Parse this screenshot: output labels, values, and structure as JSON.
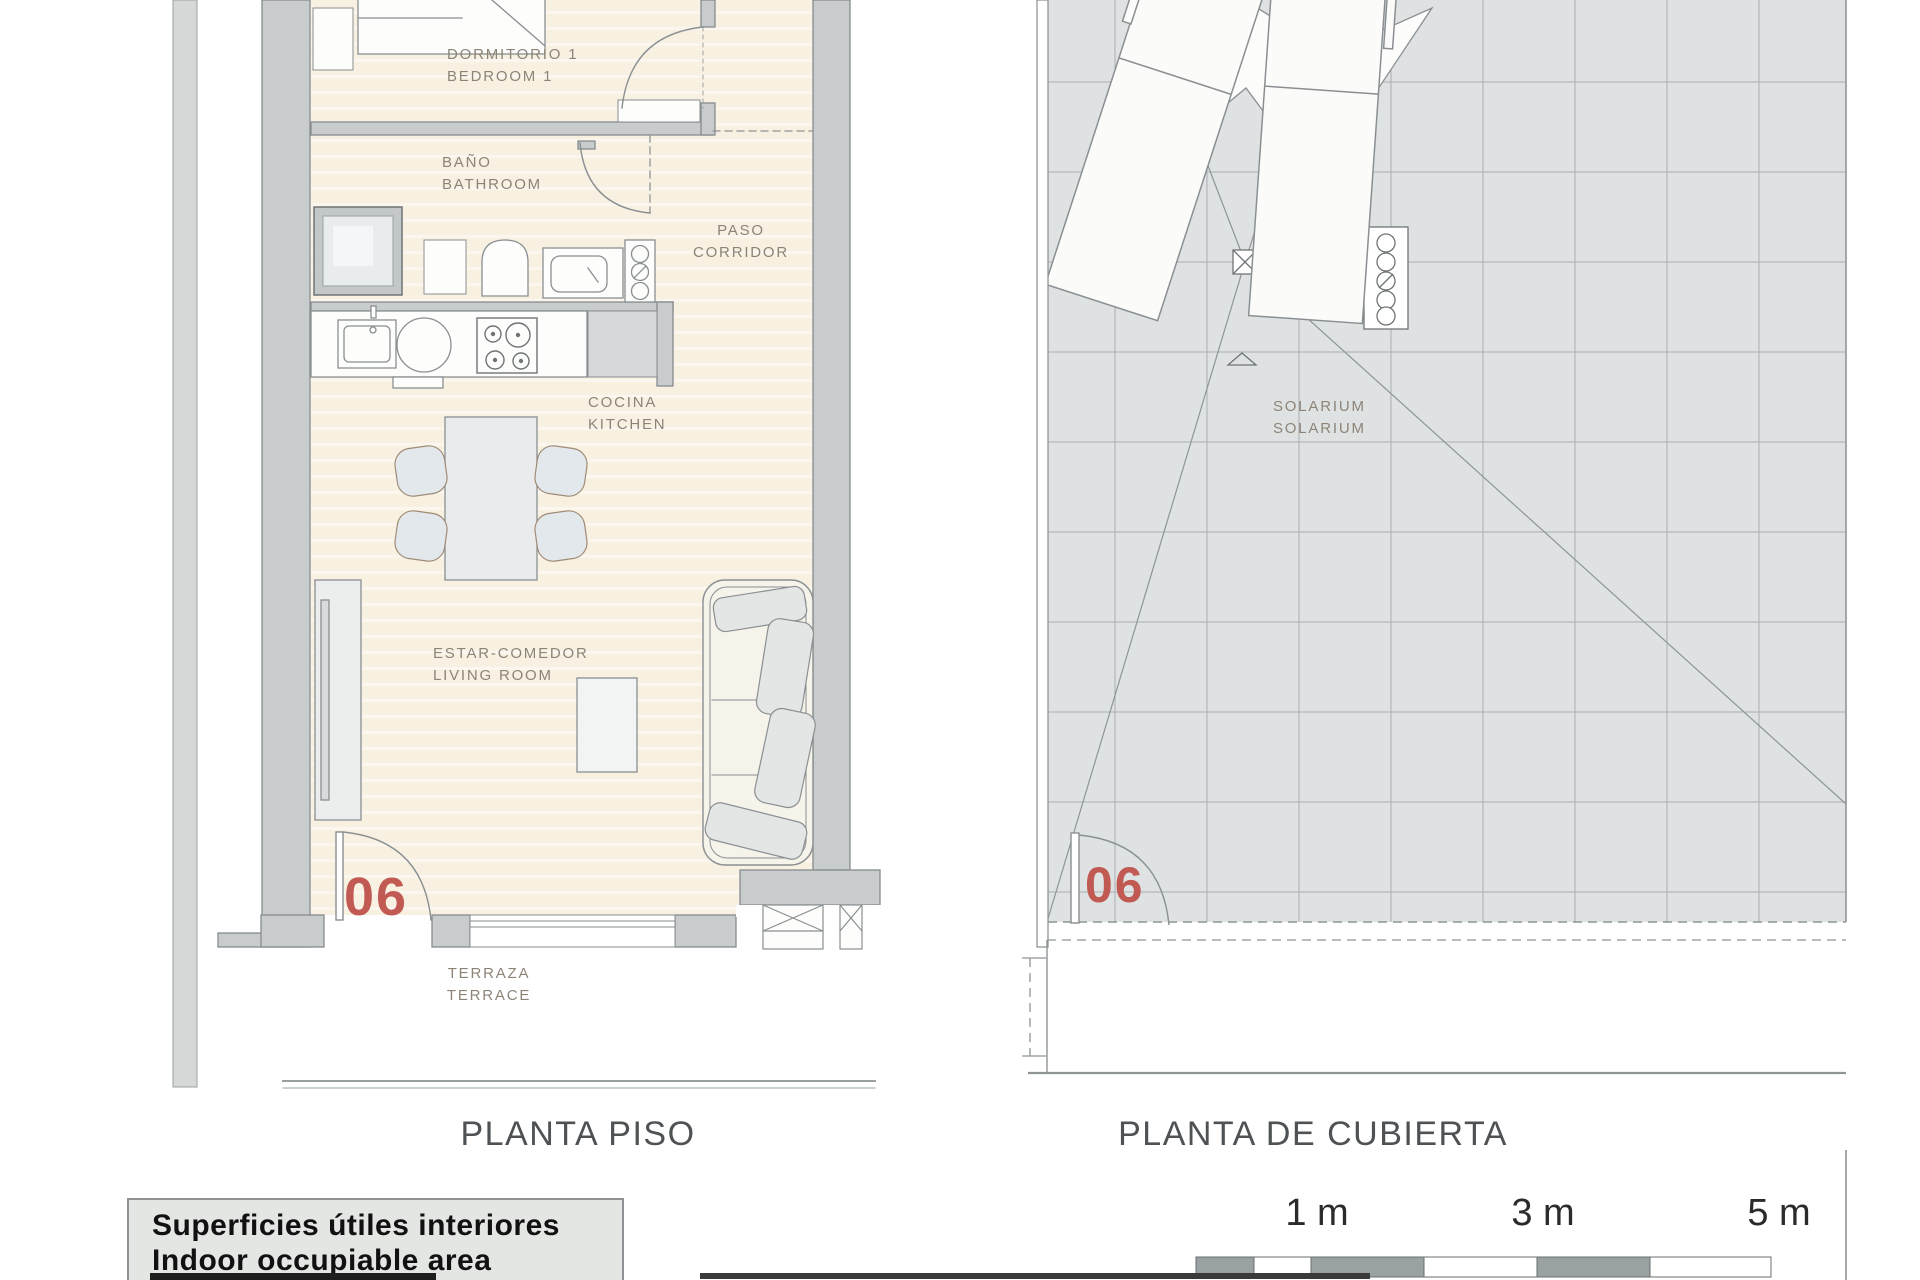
{
  "plans": {
    "floor": {
      "caption": "PLANTA PISO",
      "unit_number": "06",
      "rooms": [
        {
          "id": "bedroom",
          "label_es": "DORMITORIO 1",
          "label_en": "BEDROOM 1"
        },
        {
          "id": "bathroom",
          "label_es": "BAÑO",
          "label_en": "BATHROOM"
        },
        {
          "id": "corridor",
          "label_es": "PASO",
          "label_en": "CORRIDOR"
        },
        {
          "id": "kitchen",
          "label_es": "COCINA",
          "label_en": "KITCHEN"
        },
        {
          "id": "living",
          "label_es": "ESTAR-COMEDOR",
          "label_en": "LIVING ROOM"
        },
        {
          "id": "terrace",
          "label_es": "TERRAZA",
          "label_en": "TERRACE"
        }
      ]
    },
    "roof": {
      "caption": "PLANTA DE CUBIERTA",
      "unit_number": "06",
      "rooms": [
        {
          "id": "solarium",
          "label_es": "SOLARIUM",
          "label_en": "SOLARIUM"
        }
      ]
    }
  },
  "legend": {
    "line1": "Superficies útiles interiores",
    "line2": "Indoor occupiable area"
  },
  "scale_bar": {
    "labels": [
      "1 m",
      "3 m",
      "5 m"
    ]
  },
  "colors": {
    "accent_red": "#c05a52",
    "wall_gray": "#c9cccd",
    "line_gray": "#878c8e",
    "room_beige": "#f8f1e2",
    "tile_gray": "#dfe2e3",
    "label_brown": "#8d8477",
    "caption_gray": "#4e5254"
  }
}
